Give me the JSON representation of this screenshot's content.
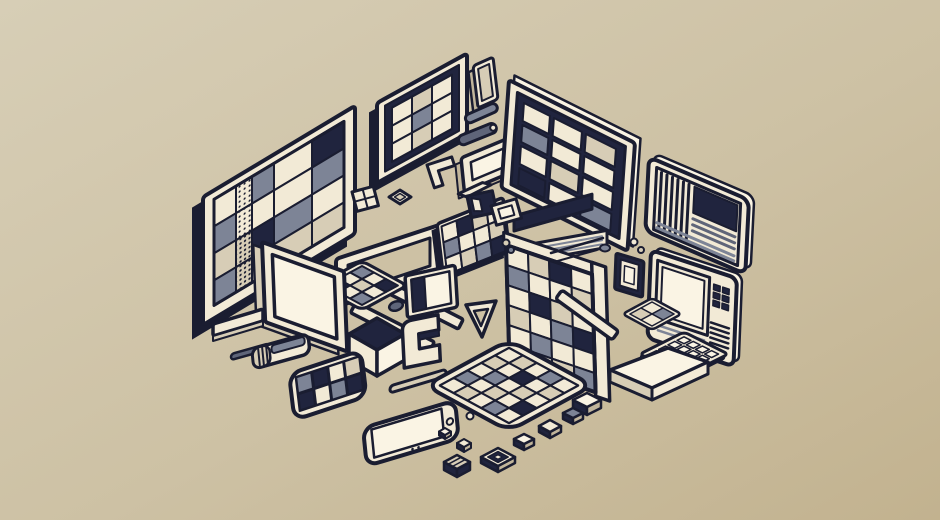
{
  "meta": {
    "kind": "digital illustration",
    "style": "isometric flat line-art collage",
    "subject": "assorted retro computing devices: monitors with mosaic screens, tablets, phones, keyboard, cubes and small parts floating on a beige background"
  },
  "palette": {
    "ink": "#1a1d31",
    "navy": "#20243e",
    "cream": "#f2ead6",
    "cream2": "#faf4e4",
    "tan": "#d7cdb6",
    "tan2": "#c1b59b",
    "gray": "#7d8496",
    "gray2": "#5f6579",
    "bg_top": "#d7ceb6",
    "bg_mid": "#cdc1a4",
    "bg_bot": "#c2b28f"
  },
  "objects": [
    "large-tiled-monitor",
    "small-grid-monitor",
    "phone-stick",
    "pill-bars",
    "wide-tray",
    "dark-tiled-monitor",
    "striped-document-monitor",
    "handheld-terminal",
    "numpad-keyboard",
    "mosaic-wall",
    "mosaic-ground-pad",
    "open-frame-with-legs",
    "white-monitor",
    "cube",
    "mini-monitor",
    "bracket",
    "triangle-outline",
    "wedge-platform",
    "flat-mosaic-tablet",
    "mosaic-phone",
    "plain-phone",
    "eraser-stick",
    "small-tray",
    "styluses",
    "keycap-trail",
    "pebbles"
  ],
  "mosaics": {
    "monitor_left": {
      "x": 11,
      "y": 9,
      "stroke": 2,
      "cols": [
        22,
        16,
        22,
        38,
        32
      ],
      "rows": [
        27,
        27,
        27,
        25
      ],
      "cells": [
        [
          "cream",
          "dots",
          "gray",
          "cream",
          "navy"
        ],
        [
          "gray",
          "dots",
          "cream",
          "cream",
          "gray"
        ],
        [
          "tan",
          "dots2",
          "navy",
          "gray",
          "cream"
        ],
        [
          "gray",
          "dots2",
          "cream",
          "tan",
          "tan"
        ]
      ]
    },
    "monitor_small": {
      "x": 15,
      "y": 13,
      "stroke": 2,
      "cols": [
        20,
        20,
        20
      ],
      "rows": [
        18,
        18,
        18
      ],
      "cells": [
        [
          "cream",
          "tan",
          "cream"
        ],
        [
          "cream",
          "gray",
          "cream"
        ],
        [
          "cream",
          "tan",
          "cream"
        ]
      ]
    },
    "monitor_dark": {
      "x": 14,
      "y": 13,
      "stroke": 2,
      "gap": 4,
      "cols": [
        30,
        32,
        34
      ],
      "rows": [
        22,
        21,
        22,
        21
      ],
      "cells": [
        [
          "cream",
          "cream",
          "tan"
        ],
        [
          "gray",
          "cream",
          "cream"
        ],
        [
          "cream",
          "tan",
          "cream"
        ],
        [
          "navy",
          "cream",
          "gray"
        ]
      ]
    },
    "wall": {
      "x": 0,
      "y": 0,
      "stroke": 2,
      "cols": [
        22,
        21,
        22,
        21
      ],
      "rows": [
        20,
        20,
        20,
        20,
        19,
        19
      ],
      "cells": [
        [
          "cream",
          "tan",
          "navy",
          "cream"
        ],
        [
          "gray",
          "cream",
          "cream",
          "tan"
        ],
        [
          "cream",
          "navy",
          "tan",
          "cream"
        ],
        [
          "tan",
          "cream",
          "gray",
          "navy"
        ],
        [
          "cream",
          "gray",
          "cream",
          "cream"
        ],
        [
          "navy",
          "cream",
          "tan",
          "gray"
        ]
      ]
    },
    "tablet_flat": {
      "x": 0,
      "y": 0,
      "stroke": 2,
      "cols": [
        15,
        15,
        15,
        15,
        15
      ],
      "rows": [
        15,
        15,
        15,
        15,
        15
      ],
      "cells": [
        [
          "cream",
          "tan",
          "cream",
          "gray",
          "cream"
        ],
        [
          "tan",
          "cream",
          "navy",
          "cream",
          "tan"
        ],
        [
          "cream",
          "gray",
          "cream",
          "tan",
          "cream"
        ],
        [
          "gray",
          "cream",
          "tan",
          "cream",
          "navy"
        ],
        [
          "cream",
          "tan",
          "cream",
          "gray",
          "cream"
        ]
      ]
    },
    "tablet_upper": {
      "x": 4,
      "y": 4,
      "stroke": 2,
      "cols": [
        15,
        15,
        15,
        15
      ],
      "rows": [
        16,
        16,
        16
      ],
      "cells": [
        [
          "cream",
          "navy",
          "tan",
          "cream"
        ],
        [
          "gray",
          "cream",
          "cream",
          "tan"
        ],
        [
          "cream",
          "tan",
          "gray",
          "navy"
        ]
      ]
    },
    "phone_mosaic": {
      "x": 6,
      "y": 5,
      "stroke": 1.5,
      "gap": 1.5,
      "cols": [
        16,
        16,
        16,
        16
      ],
      "rows": [
        17,
        17
      ],
      "cells": [
        [
          "gray",
          "navy",
          "cream",
          "tan"
        ],
        [
          "navy",
          "cream",
          "gray",
          "navy"
        ]
      ]
    },
    "pad": {
      "x": 0,
      "y": 0,
      "stroke": 2,
      "cols": [
        13,
        13,
        13
      ],
      "rows": [
        13,
        13,
        13
      ],
      "cells": [
        [
          "gray",
          "cream",
          "navy"
        ],
        [
          "cream",
          "tan",
          "cream"
        ],
        [
          "navy",
          "cream",
          "gray"
        ]
      ]
    },
    "pad2": {
      "x": 0,
      "y": 0,
      "stroke": 1.5,
      "cols": [
        12,
        12
      ],
      "rows": [
        12,
        12
      ],
      "cells": [
        [
          "cream",
          "gray"
        ],
        [
          "tan",
          "cream"
        ]
      ]
    },
    "keyboard_keys": {
      "x": 4,
      "y": 4,
      "stroke": 1.5,
      "gap": 2.5,
      "cols": [
        10,
        10,
        10,
        10
      ],
      "rows": [
        10,
        10,
        10,
        10
      ],
      "cells": [
        [
          "cream2",
          "cream2",
          "cream2",
          "cream2"
        ],
        [
          "cream2",
          "cream2",
          "cream2",
          "cream2"
        ],
        [
          "cream2",
          "cream2",
          "cream2",
          "cream2"
        ],
        [
          "cream2",
          "cream2",
          "cream2",
          "cream2"
        ]
      ]
    },
    "handheld_keys": {
      "x": 62,
      "y": 12,
      "stroke": 1.5,
      "gap": 2.5,
      "cols": [
        9,
        9
      ],
      "rows": [
        8,
        8,
        8
      ],
      "cells": [
        [
          "navy",
          "navy"
        ],
        [
          "navy",
          "navy"
        ],
        [
          "navy",
          "navy"
        ]
      ]
    }
  }
}
